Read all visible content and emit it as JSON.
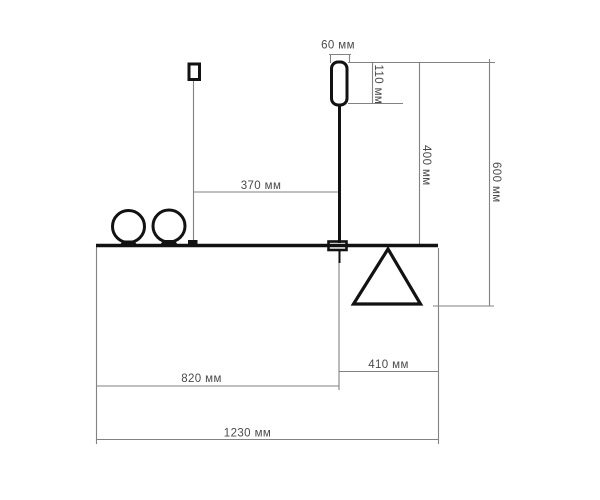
{
  "drawing": {
    "type": "technical-dimension-diagram",
    "unit": "мм",
    "labels": {
      "d60": "60 мм",
      "d110": "110 мм",
      "d370": "370 мм",
      "d400": "400 мм",
      "d600": "600 мм",
      "d820": "820 мм",
      "d410": "410 мм",
      "d1230": "1230 мм"
    },
    "values_mm": [
      60,
      110,
      370,
      400,
      600,
      820,
      410,
      1230
    ],
    "colors": {
      "outline": "#121212",
      "dimension_line": "#828282",
      "label_text": "#4a4a4a",
      "background": "#ffffff"
    }
  }
}
